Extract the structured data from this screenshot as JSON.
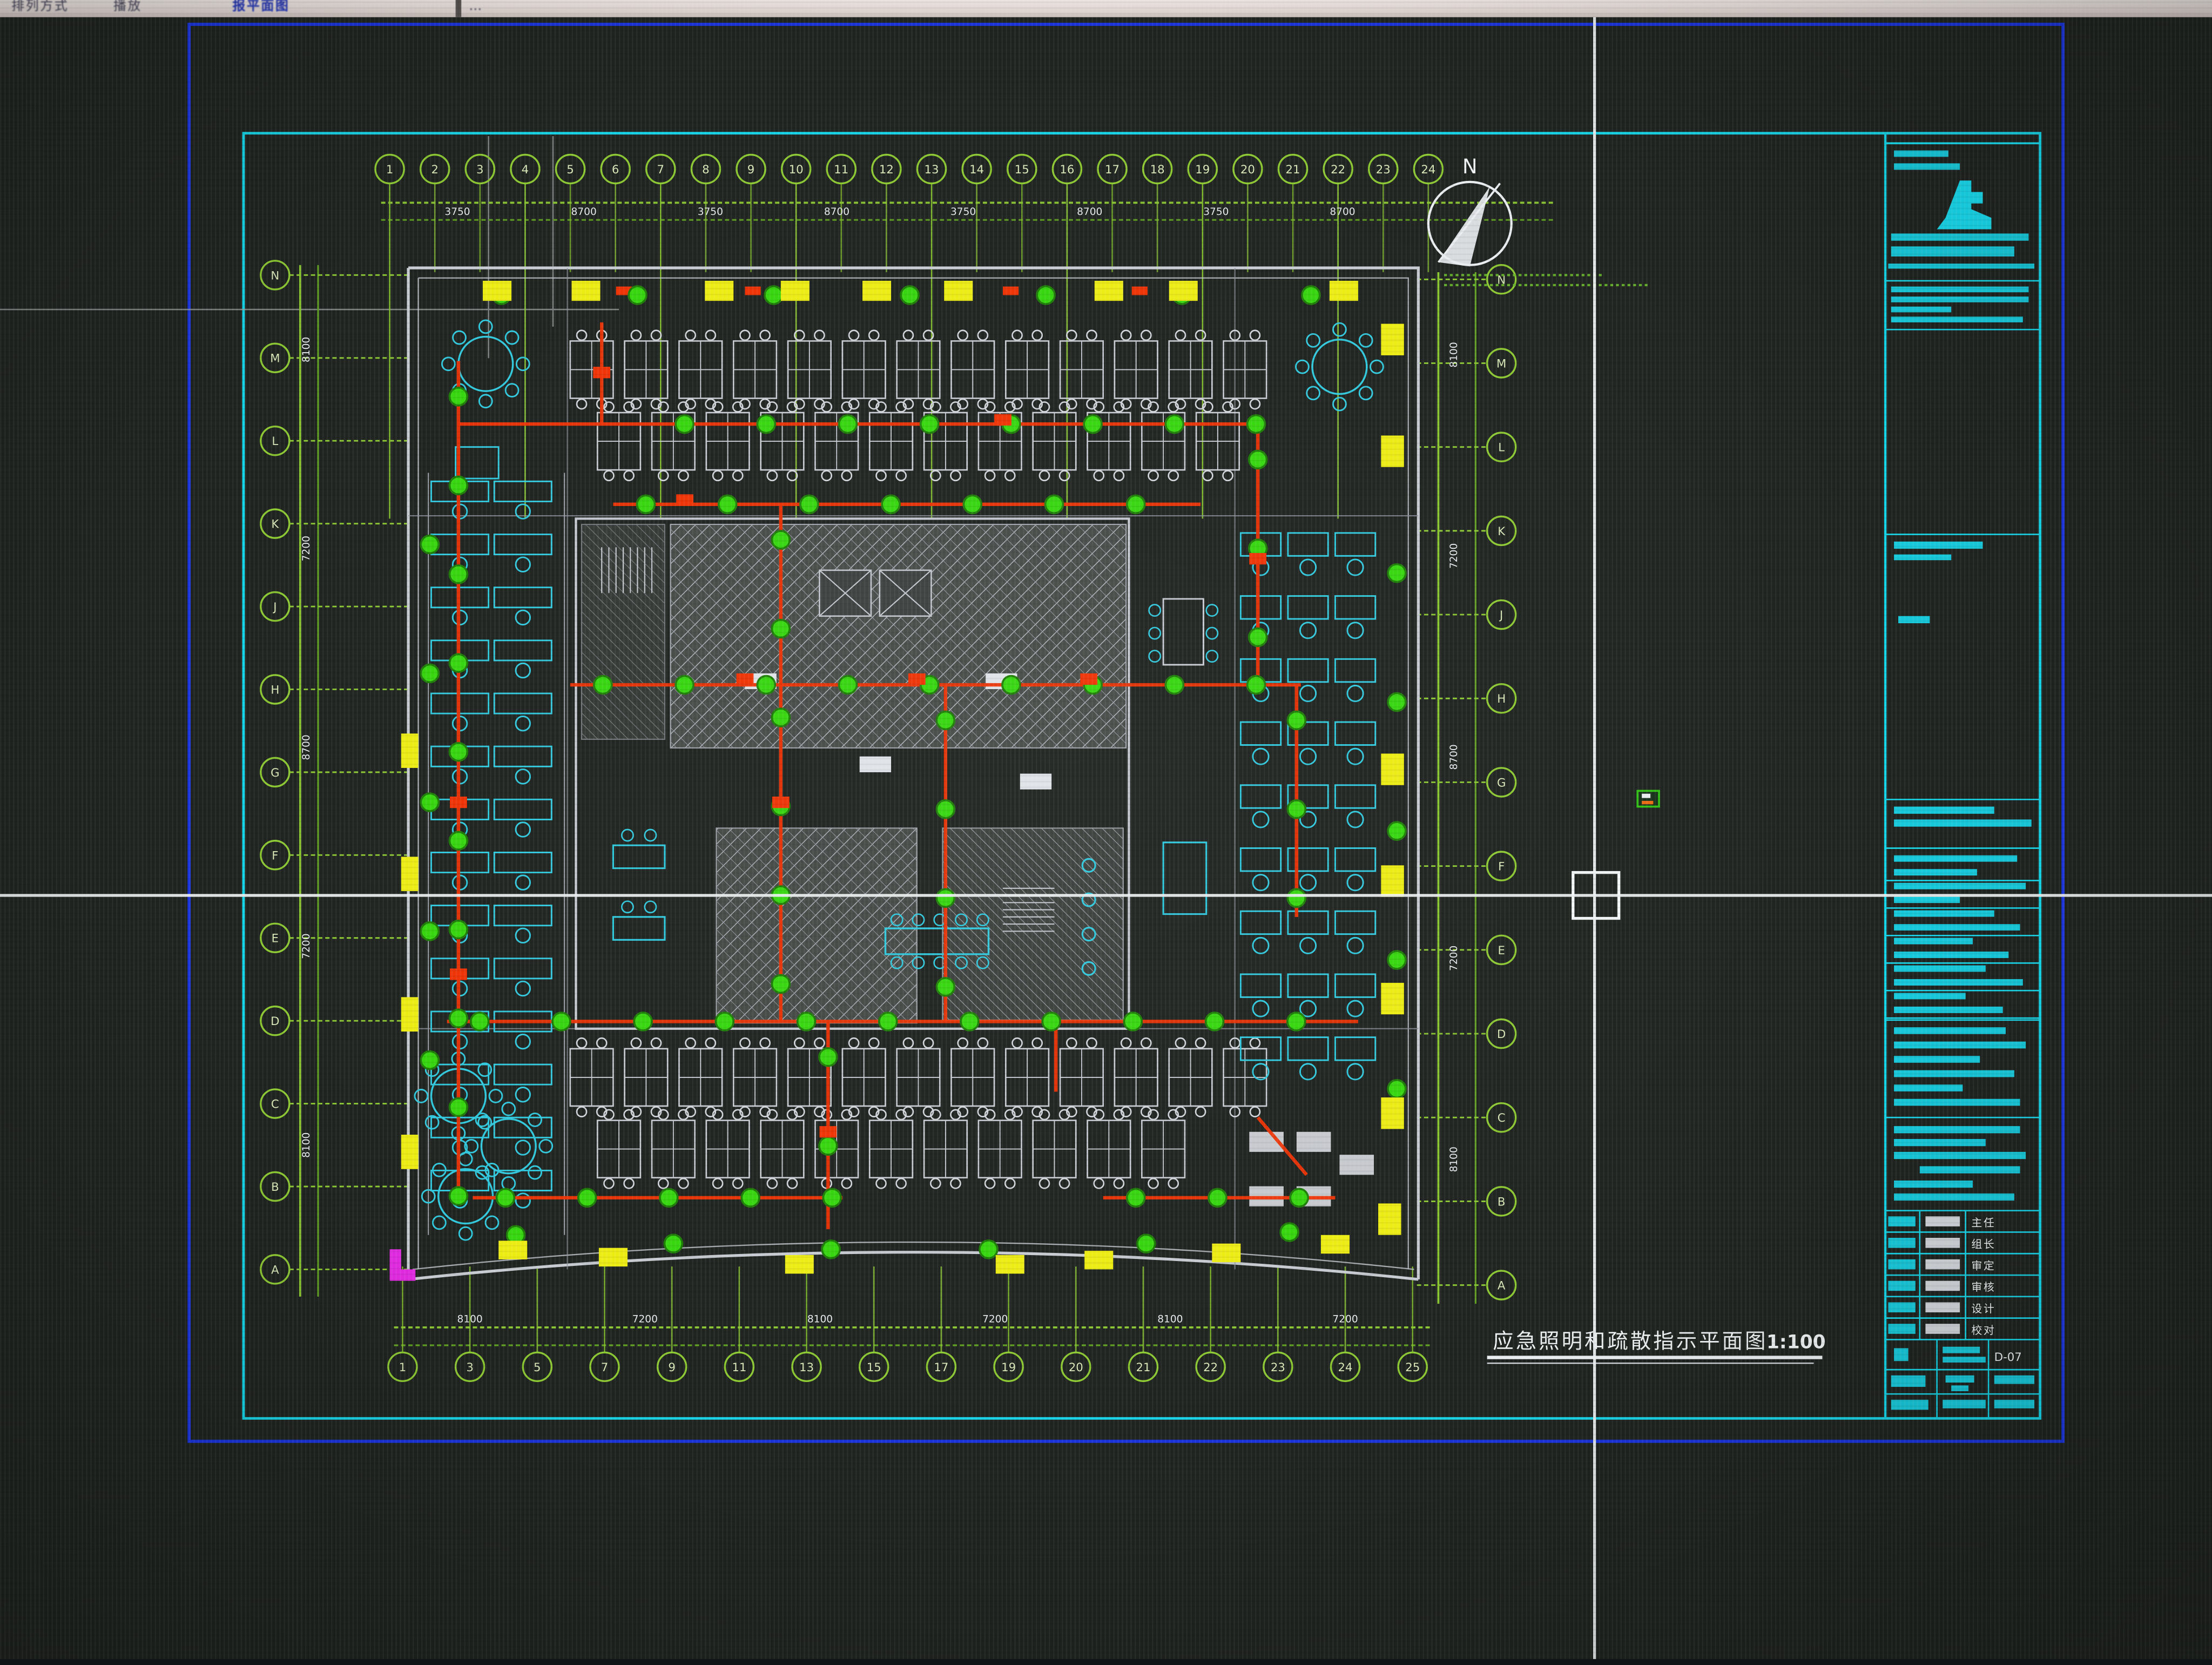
{
  "toolbar": {
    "items": [
      "排列方式",
      "播放"
    ],
    "selected_item": "报平面图",
    "more_marks": "…"
  },
  "drawing": {
    "title": "应急照明和疏散指示平面图",
    "scale_label": "1:100",
    "north_label": "N",
    "grid": {
      "top_labels": [
        "1",
        "2",
        "3",
        "4",
        "5",
        "6",
        "7",
        "8",
        "9",
        "10",
        "11",
        "12",
        "13",
        "14",
        "15",
        "16",
        "17",
        "18",
        "19",
        "20",
        "21",
        "22",
        "23",
        "24"
      ],
      "bottom_labels": [
        "1",
        "3",
        "5",
        "7",
        "9",
        "11",
        "13",
        "15",
        "17",
        "19",
        "20",
        "21",
        "22",
        "23",
        "24",
        "25"
      ],
      "left_labels": [
        "N",
        "M",
        "L",
        "K",
        "J",
        "H",
        "G",
        "F",
        "E",
        "D",
        "C",
        "B",
        "A"
      ],
      "right_labels": [
        "N",
        "M",
        "L",
        "K",
        "J",
        "H",
        "G",
        "F",
        "E",
        "D",
        "C",
        "B",
        "A"
      ]
    },
    "dimensions": {
      "top": [
        "3750",
        "8700",
        "3750",
        "8700",
        "3750",
        "8700",
        "3750",
        "8700"
      ],
      "bottom": [
        "8100",
        "7200",
        "8100",
        "7200",
        "8100",
        "7200"
      ],
      "left": [
        "8100",
        "7200",
        "8700",
        "7200",
        "8100"
      ],
      "right": [
        "8100",
        "7200",
        "8700",
        "7200",
        "8100"
      ]
    }
  },
  "title_block": {
    "drawing_no": "D-07",
    "signature_rows": [
      "主任",
      "组长",
      "审定",
      "审核",
      "设计",
      "校对"
    ]
  },
  "colors": {
    "background": "#1f2420",
    "frame_blue": "#1a35e0",
    "frame_cyan": "#17d7ea",
    "grid_green": "#8cc832",
    "grid_chain": "#5f9e20",
    "circuit_red": "#ef3305",
    "light_green": "#36d60f",
    "highlight_yellow": "#ecec14",
    "furniture_cyan": "#31c9de",
    "wall_gray": "#c6cbd1",
    "dim_text": "#e8ecef",
    "magenta": "#e02ae0",
    "crosshair_white": "#f0f4f4"
  }
}
